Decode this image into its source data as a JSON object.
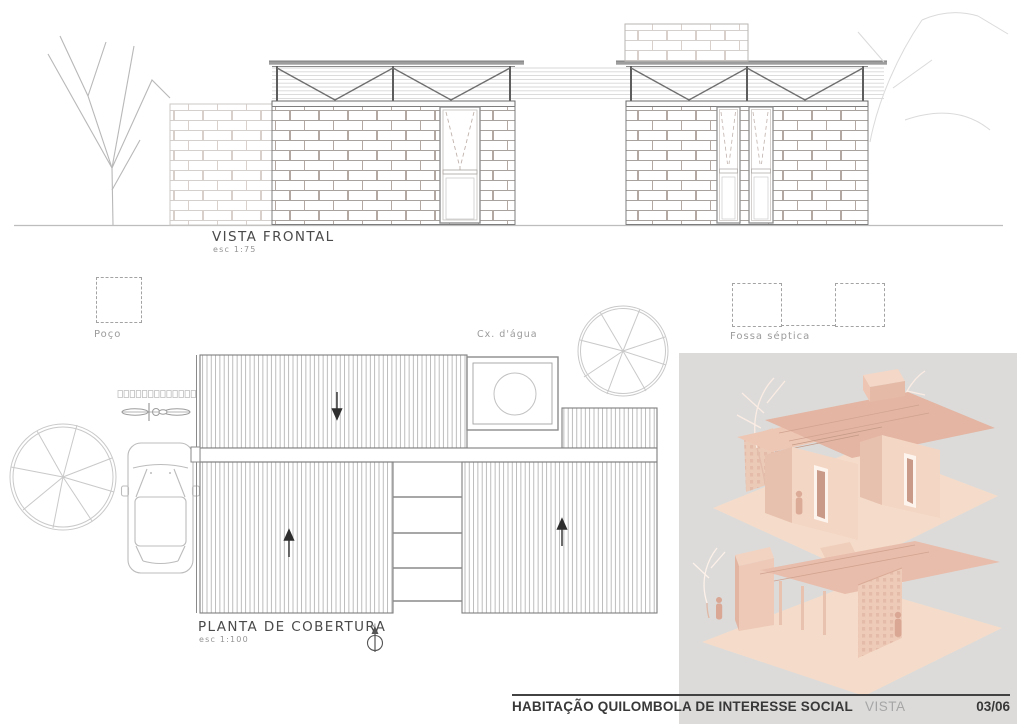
{
  "front_view": {
    "title": "VISTA FRONTAL",
    "scale": "esc  1:75"
  },
  "roof_plan": {
    "title": "PLANTA DE COBERTURA",
    "scale": "esc  1:100",
    "north": "N"
  },
  "site_labels": {
    "well": "Poço",
    "water_box": "Cx.  d'água",
    "septic": "Fossa  séptica"
  },
  "footer": {
    "project": "HABITAÇÃO QUILOMBOLA DE INTERESSE SOCIAL",
    "sheet": "VISTA",
    "page": "03/06"
  },
  "palette": {
    "paper": "#ffffff",
    "render_panel_gray": "#dcdbda",
    "footer_line": "#424242",
    "drawing_line_dark": "#7e7e7e",
    "drawing_line_light": "#c9c9c9",
    "render_wall": "#f4d6c4",
    "render_wall_shade": "#e8c0ae",
    "render_roof": "#e3b5a2",
    "render_ground": "#f5dcca"
  }
}
